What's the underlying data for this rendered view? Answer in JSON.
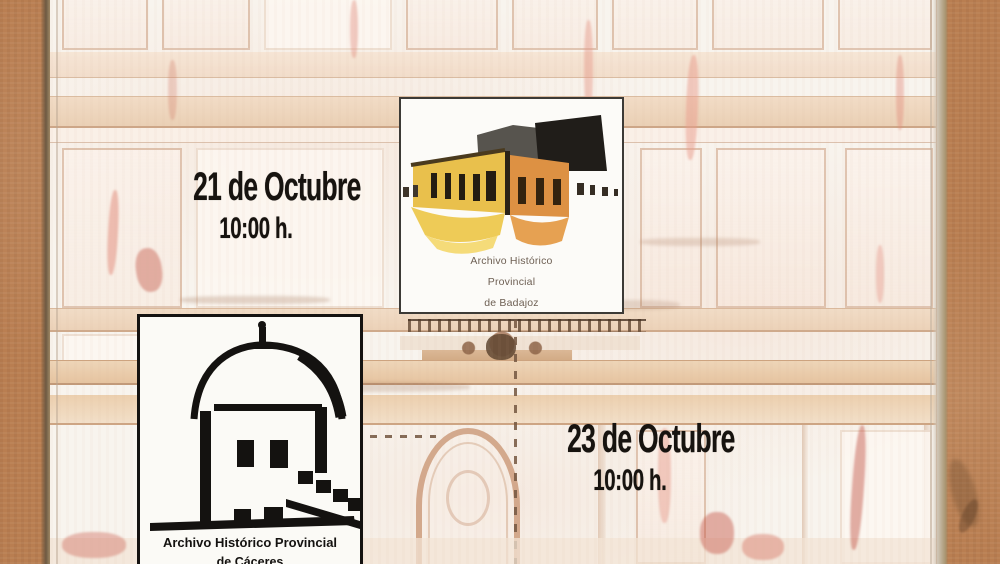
{
  "poster": {
    "sessions": [
      {
        "date": "21 de Octubre",
        "time": "10:00 h."
      },
      {
        "date": "23 de Octubre",
        "time": "10:00 h."
      }
    ],
    "logos": {
      "badajoz": {
        "caption_lines": [
          "Archivo Histórico",
          "Provincial",
          "de Badajoz"
        ]
      },
      "caceres": {
        "caption_lines": [
          "Archivo Histórico Provincial",
          "de Cáceres"
        ]
      }
    },
    "colors": {
      "kraft_background": "#b97e51",
      "poster_paper": "#f8f4ee",
      "facade_tan": "#e8cba8",
      "facade_red_accent": "#c6604f",
      "ink_black": "#17130f",
      "logo_yellow": "#e9c04c",
      "logo_orange": "#dd9143",
      "logo_roof_gray": "#57544e",
      "logo_roof_black": "#201d19"
    }
  }
}
